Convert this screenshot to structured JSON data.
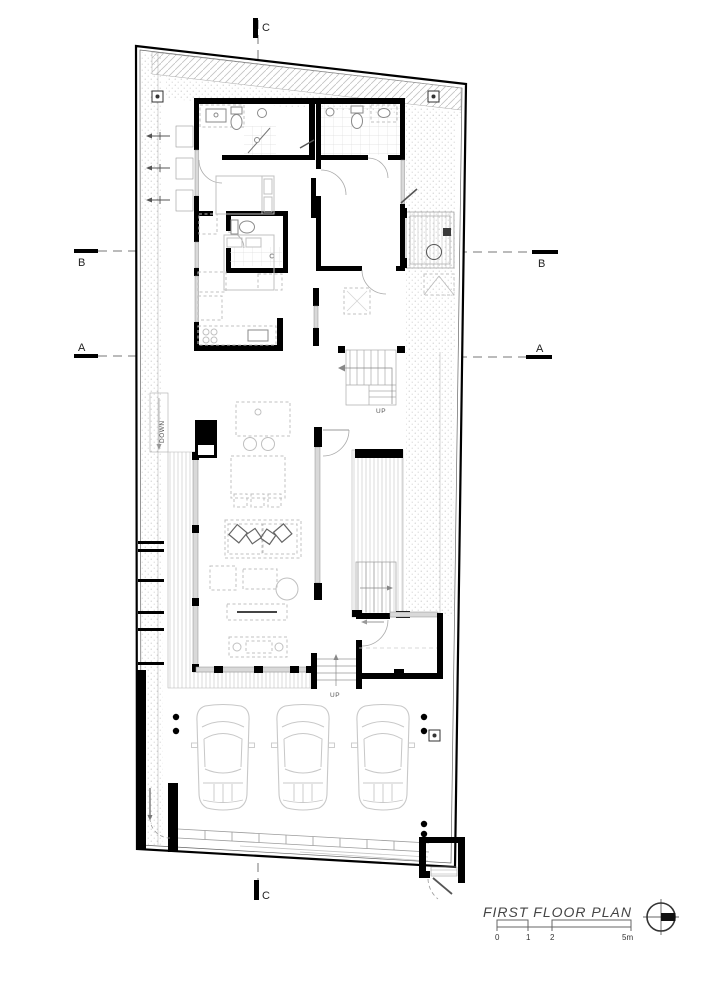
{
  "plan": {
    "title": "FIRST FLOOR PLAN",
    "section_markers": {
      "c_top": "C",
      "c_bottom": "C",
      "b_left": "B",
      "b_right": "B",
      "a_left": "A",
      "a_right": "A"
    },
    "annotations": {
      "stair_up": "UP",
      "garage_steps_up": "UP",
      "ramp_down": "DOWN"
    },
    "scale_bar": {
      "tick_0": "0",
      "tick_1": "1",
      "tick_2": "2",
      "tick_5": "5m"
    },
    "colors": {
      "wall": "#000000",
      "furniture_line": "#c0c0c0",
      "glass": "#d9d9d9",
      "hatch": "#cfcfcf",
      "section_line": "#777777",
      "title_text": "#444444",
      "paper": "#ffffff"
    }
  }
}
